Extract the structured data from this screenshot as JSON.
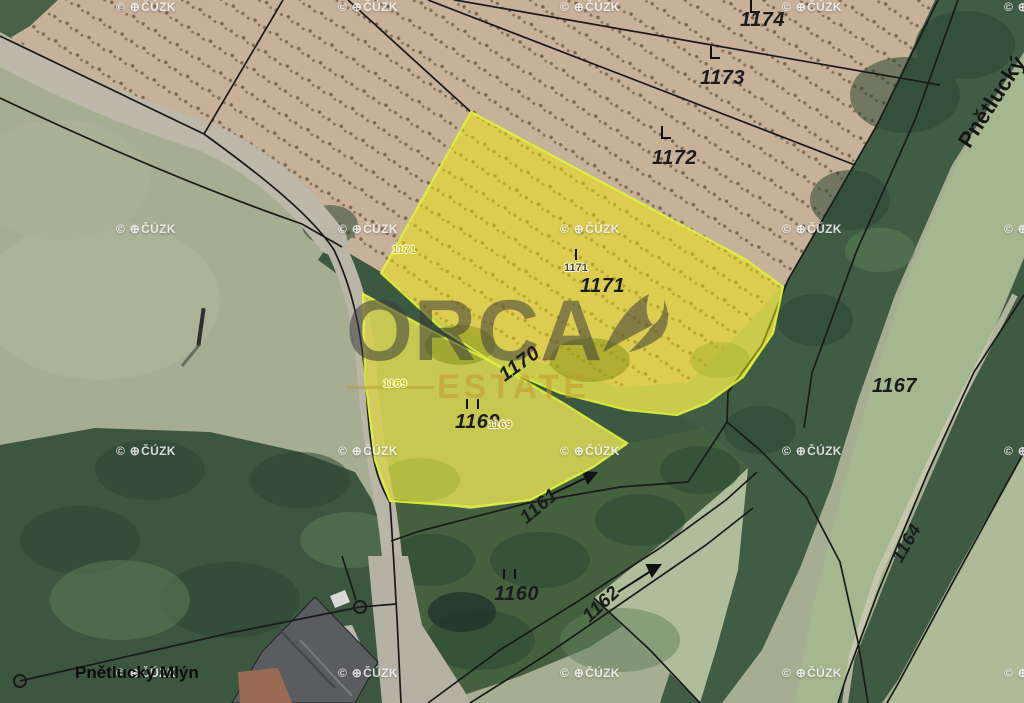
{
  "watermark": {
    "copyright_symbol": "©",
    "globe_glyph": "⊕",
    "org": "ČÚZK"
  },
  "brand": {
    "name": "ORCA",
    "subtitle": "ESTATE"
  },
  "place_labels": {
    "mill": "Pnětlucký Mlýn",
    "stream": "Pnětlucký"
  },
  "parcel_labels": {
    "p1174": "1174",
    "p1173": "1173",
    "p1172": "1172",
    "p1171": "1171",
    "p1171_point": "1171",
    "p1171_point_left": "1171",
    "p1170": "1170",
    "p1169": "1169",
    "p1169_point": "1169",
    "p1169_point_left": "1169",
    "p1161": "1161",
    "p1160": "1160",
    "p1162": "1162",
    "p1164": "1164",
    "p1167": "1167"
  },
  "highlighted_parcels": [
    "1171",
    "1169"
  ],
  "colors": {
    "highlight_fill": "#f2ea00",
    "highlight_border": "#dff23c",
    "brand_text": "#3c3c3c",
    "brand_sub": "#c19a2e",
    "cadastre_line": "#1a1a1a"
  }
}
